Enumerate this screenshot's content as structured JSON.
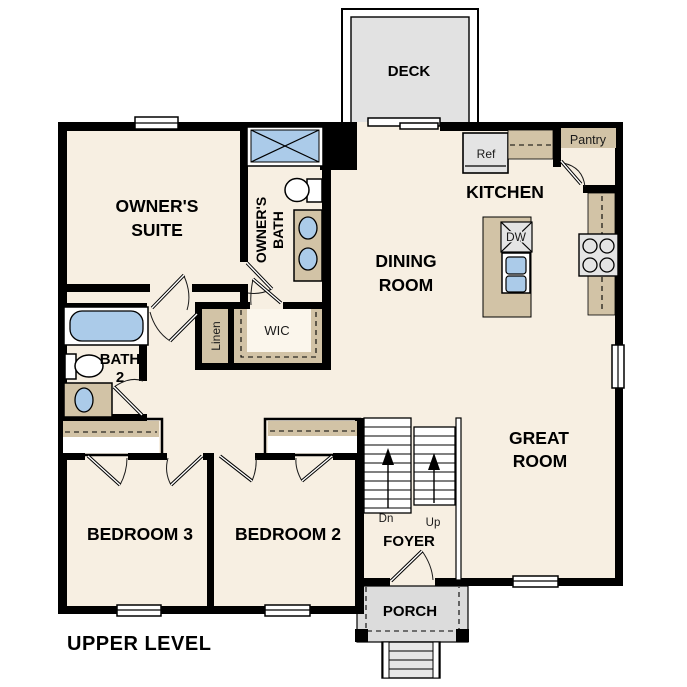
{
  "colors": {
    "floor": "#f7efe2",
    "cabinet": "#d2c3a6",
    "water": "#abcbe9",
    "appliance": "#e4e4e4",
    "deck": "#e2e2e2",
    "porch": "#dcdcdc",
    "wall": "#000000"
  },
  "labels": {
    "deck": "DECK",
    "owners_suite1": "OWNER'S",
    "owners_suite2": "SUITE",
    "owners_bath1": "OWNER'S",
    "owners_bath2": "BATH",
    "kitchen": "KITCHEN",
    "ref": "Ref",
    "pantry": "Pantry",
    "dw": "DW",
    "dining1": "DINING",
    "dining2": "ROOM",
    "great1": "GREAT",
    "great2": "ROOM",
    "bath2_1": "BATH",
    "bath2_2": "2",
    "linen": "Linen",
    "wic": "WIC",
    "bedroom3": "BEDROOM 3",
    "bedroom2": "BEDROOM 2",
    "stairs_dn": "Dn",
    "stairs_up": "Up",
    "foyer": "FOYER",
    "porch": "PORCH",
    "level": "UPPER LEVEL"
  }
}
